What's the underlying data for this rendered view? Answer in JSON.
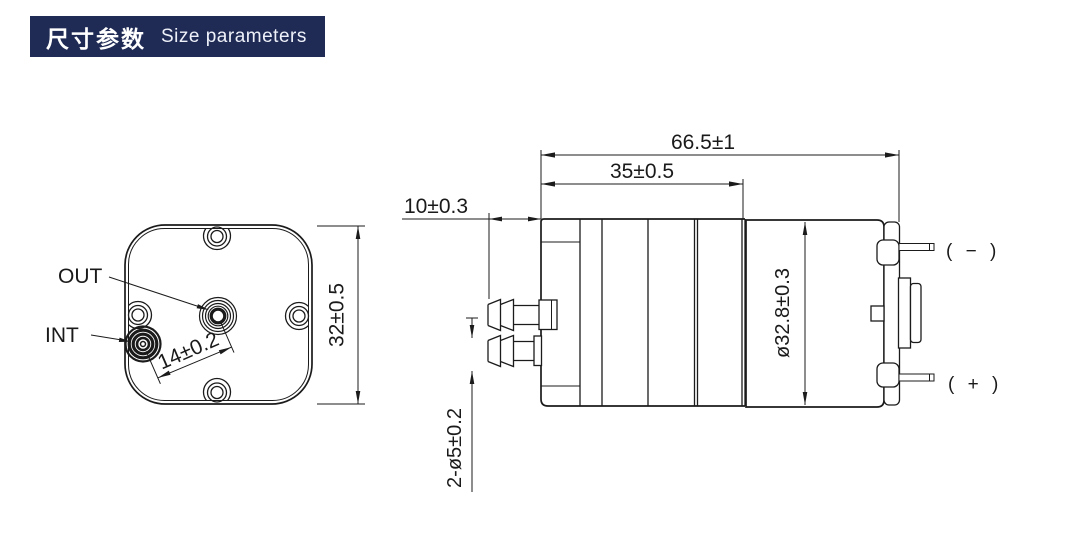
{
  "header": {
    "title_zh": "尺寸参数",
    "title_en": "Size parameters",
    "bg_color": "#202b55",
    "text_color": "#ffffff"
  },
  "front_view": {
    "labels": {
      "out": "OUT",
      "int": "INT"
    },
    "dimensions": {
      "port_spacing": "14±0.2",
      "body_height": "32±0.5"
    }
  },
  "side_view": {
    "dimensions": {
      "total_length": "66.5±1",
      "pump_length": "35±0.5",
      "barb_protrusion": "10±0.3",
      "barb_diameter": "2-ø5±0.2",
      "motor_diameter": "ø32.8±0.3"
    },
    "terminals": {
      "negative": "( − )",
      "positive": "( + )"
    }
  },
  "colors": {
    "line": "#1b1b1b",
    "background": "#ffffff",
    "accent": "#202b55"
  }
}
